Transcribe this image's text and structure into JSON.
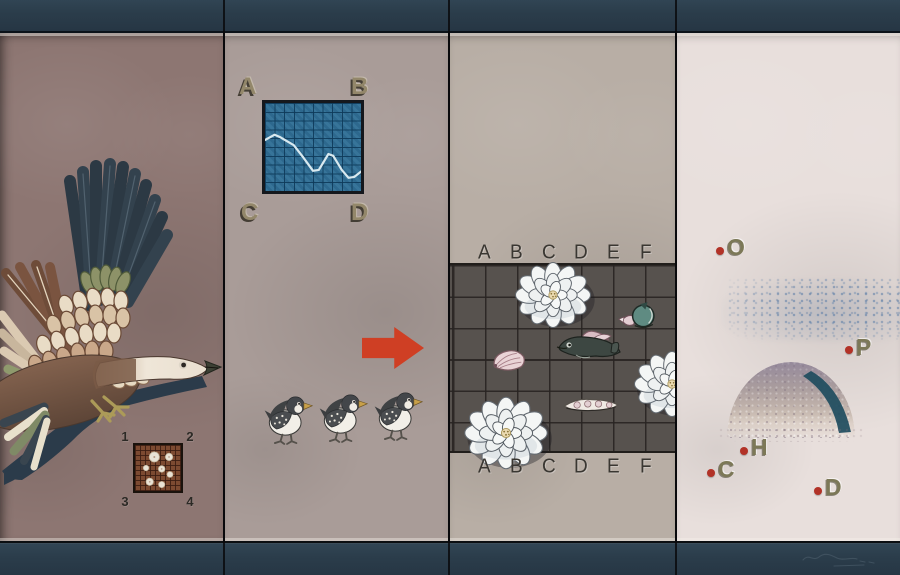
{
  "artwork": {
    "type": "four-panel painting",
    "palette": {
      "frame_band": "#2c3d4b",
      "panel1_bg": "#8d7672",
      "panel2_bg": "#a99c98",
      "panel3_bg": "#b8aea5",
      "panel4_bg": "#e8dfdc",
      "accent_red": "#cf3f24",
      "red_dot": "#b23227",
      "chart_blue": "#2f6e95",
      "stencil_olive": "#93876a",
      "board_gray": "#57524e",
      "rust_grid": "#7c4a31"
    }
  },
  "panel1": {
    "grid_numbers": [
      "1",
      "2",
      "3",
      "4"
    ],
    "icons": [
      "goose-illustration",
      "flower-dot-grid"
    ]
  },
  "panel2": {
    "corner_letters": [
      "A",
      "B",
      "C",
      "D"
    ],
    "icons": [
      "line-chart",
      "right-arrow",
      "chick-illustration"
    ]
  },
  "panel3": {
    "column_letters_top": [
      "A",
      "B",
      "C",
      "D",
      "E",
      "F"
    ],
    "column_letters_bottom": [
      "A",
      "B",
      "C",
      "D",
      "E",
      "F"
    ],
    "board_pieces": [
      "peony",
      "sea-snail",
      "fish",
      "clam",
      "peony",
      "seed-pod",
      "peony"
    ]
  },
  "panel4": {
    "stencil_letters": [
      "O",
      "P",
      "H",
      "C",
      "D"
    ],
    "icons": [
      "stipple-cloud",
      "stone-dome"
    ]
  },
  "chart_data": {
    "type": "line",
    "title": "inset grid chart (panel 2)",
    "x_range": [
      0,
      10
    ],
    "y_range": [
      0,
      10
    ],
    "gridlines": 10,
    "points": [
      [
        0,
        5.8
      ],
      [
        1,
        6.4
      ],
      [
        1.6,
        6.1
      ],
      [
        3,
        5.2
      ],
      [
        4,
        3.8
      ],
      [
        5,
        2.3
      ],
      [
        5.6,
        2.4
      ],
      [
        6.6,
        4.2
      ],
      [
        7.1,
        4.0
      ],
      [
        8,
        2.4
      ],
      [
        8.7,
        1.5
      ],
      [
        9.3,
        1.6
      ],
      [
        10,
        2.2
      ]
    ]
  }
}
